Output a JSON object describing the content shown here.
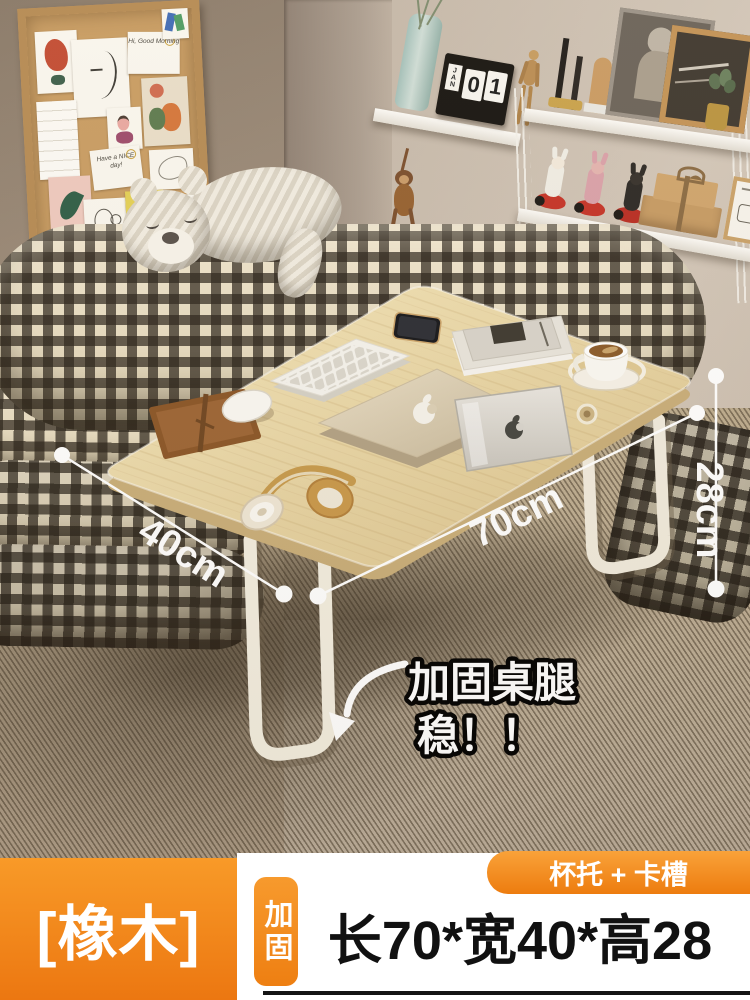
{
  "annotations": {
    "width": "40cm",
    "length": "70cm",
    "height": "28cm",
    "callout_line1": "加固桌腿",
    "callout_line2": "稳！！"
  },
  "banner": {
    "variant": "[橡木]",
    "tab": "加固",
    "size": "长70*宽40*高28",
    "feature": "杯托 + 卡槽"
  },
  "shelf": {
    "calendar_month": "JAN",
    "calendar_digit_tens": "0",
    "calendar_digit_ones": "1"
  },
  "corkboard": {
    "note_morning": "Hi, Good Morning",
    "note_nice_day": "Have a NICE day!"
  },
  "colors": {
    "accent_orange": "#f08419",
    "banner_text": "#111111",
    "wood_top": "#ecd9a8",
    "annotation_white": "#ffffff"
  }
}
